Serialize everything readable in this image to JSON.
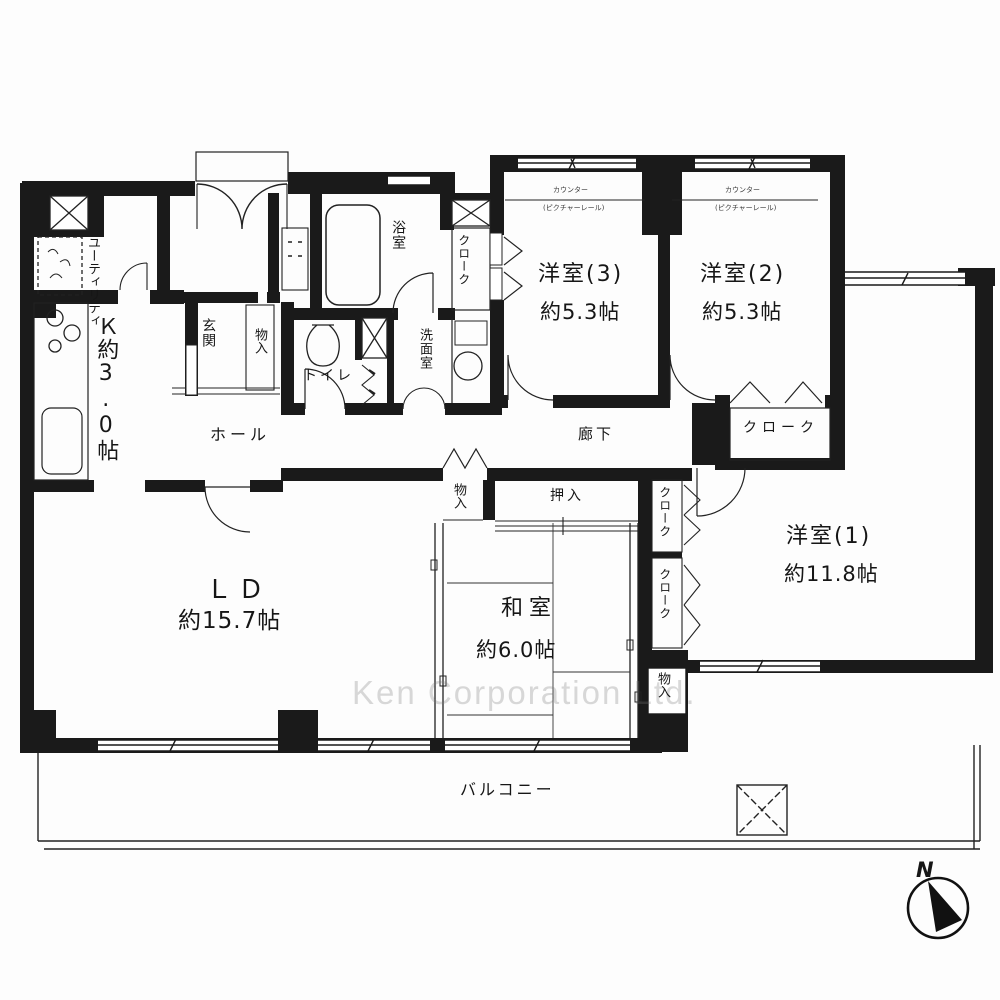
{
  "watermark": "Ken Corporation Ltd.",
  "compass": {
    "north_label": "N"
  },
  "rooms": {
    "ld": {
      "name": "ＬＤ",
      "size": "約15.7帖"
    },
    "kitchen": {
      "label": "Ｋ約3.0帖"
    },
    "washitsu": {
      "name": "和室",
      "size": "約6.0帖"
    },
    "yoshitsu1": {
      "name": "洋室(1)",
      "size": "約11.8帖"
    },
    "yoshitsu2": {
      "name": "洋室(2)",
      "size": "約5.3帖",
      "counter_note": "カウンター",
      "bracket_note": "(ピクチャーレール)"
    },
    "yoshitsu3": {
      "name": "洋室(3)",
      "size": "約5.3帖",
      "counter_note": "カウンター",
      "bracket_note": "(ピクチャーレール)"
    },
    "balcony": {
      "label": "バルコニー"
    }
  },
  "labels": {
    "utility": "ユーティリティ",
    "genkan": "玄関",
    "hall": "ホール",
    "corridor": "廊下",
    "toilet": "トイレ",
    "bath": "浴室",
    "washroom": "洗面室",
    "cloak_bath": "クローク",
    "cloak_y2": "クローク",
    "cloak_y1_upper": "クローク",
    "cloak_y1_lower": "クローク",
    "storage_entrance": "物入",
    "storage_center": "物入",
    "storage_south": "物入",
    "oshiire": "押入"
  }
}
